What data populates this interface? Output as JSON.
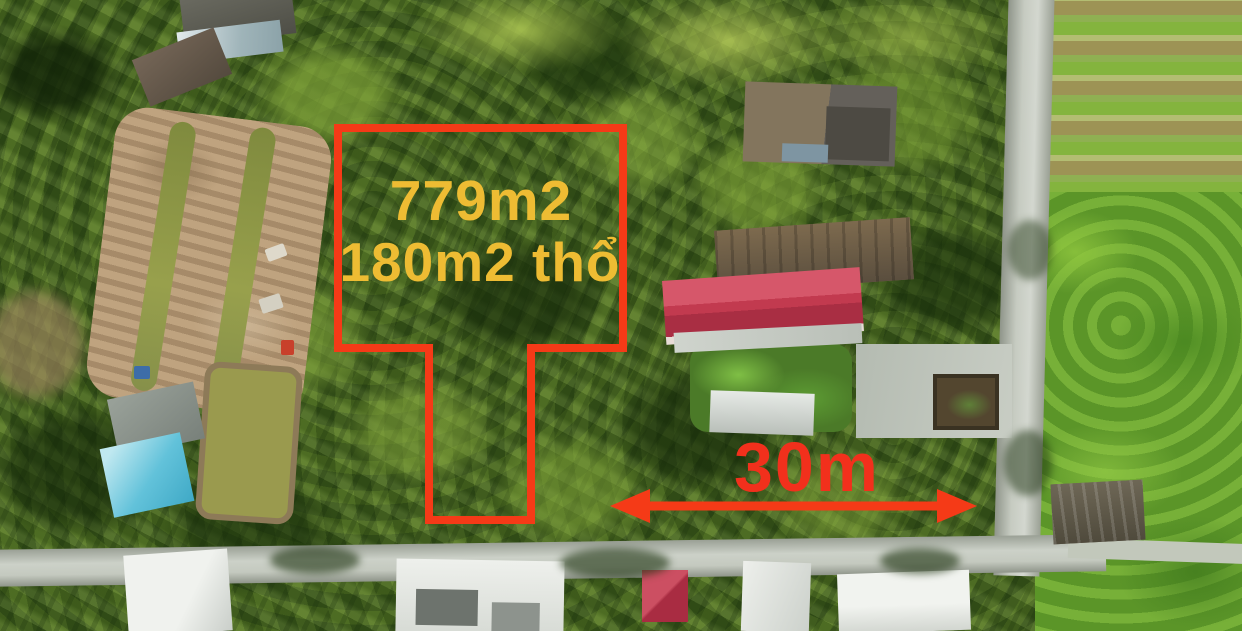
{
  "photo": {
    "description": "Aerial drone photo of a coconut-palm land plot for sale with painted boundary and measurements",
    "plot": {
      "area_total": "779m2",
      "area_residential": "180m2 thổ",
      "frontage_width": "30m",
      "outline_color": "#f53a17",
      "area_label_color": "#eebc33",
      "width_label_color": "#f2301c"
    }
  }
}
